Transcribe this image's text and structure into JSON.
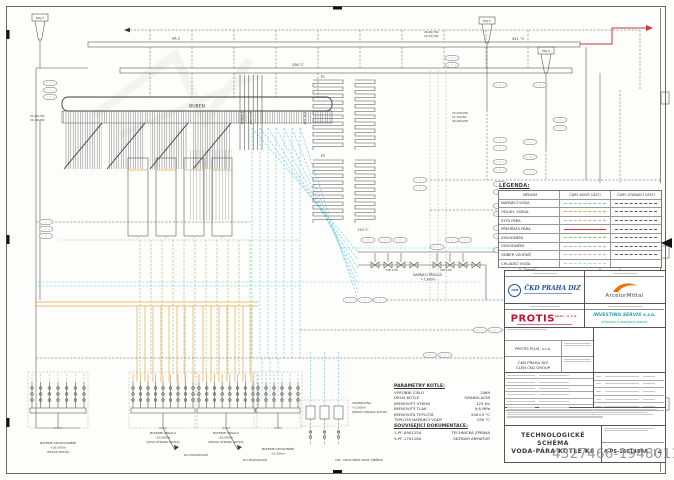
{
  "sheet": {
    "watermark": "4327466-19480111"
  },
  "colors": {
    "feedwater": "#6ec8dc",
    "blowdown": "#e2a84e",
    "saturated_steam": "#c0b890",
    "superheated_steam": "#cf3440",
    "flooding": "#8cc45e",
    "drain": "#b0b0b0",
    "sampling": "#dfa4c2",
    "cooling_water": "#a8dce8",
    "brand_blue": "#1b4e9b",
    "brand_red": "#c41230",
    "brand_orange": "#f06f00",
    "brand_teal": "#2aa0a8"
  },
  "legend": {
    "title": "LEGENDA:",
    "headers": [
      "MÉDIUM",
      "ČÁRY–NOVÉ ČÁSTI",
      "ČÁRY–STÁVAJÍCÍ ČÁSTI"
    ],
    "rows": [
      {
        "label": "NAPÁJECÍ VODA",
        "new": "#6ec8dc",
        "new_style": "dashed",
        "old_style": "dashed"
      },
      {
        "label": "ODLUH, ODKAL",
        "new": "#e2a84e",
        "new_style": "dashed",
        "old_style": "dashed"
      },
      {
        "label": "SYTÁ PÁRA",
        "new": "#c0b890",
        "new_style": "dashed",
        "old_style": "dashed"
      },
      {
        "label": "PŘEHŘÁTÁ PÁRA",
        "new": "#cf3440",
        "new_style": "solid",
        "old_style": "dashed"
      },
      {
        "label": "ZAVODNĚNÍ",
        "new": "#8cc45e",
        "new_style": "dashed",
        "old_style": "dashed"
      },
      {
        "label": "ODVODNĚNÍ",
        "new": "#b0b0b0",
        "new_style": "dashed",
        "old_style": "dashed"
      },
      {
        "label": "ODBĚR VZORKŮ",
        "new": "#dfa4c2",
        "new_style": "dashed",
        "old_style": "dashed"
      },
      {
        "label": "CHLADÍCÍ VODA",
        "new": "#a8dce8",
        "new_style": "dashed",
        "old_style": "none"
      }
    ]
  },
  "parameters": {
    "title": "PARAMETRY KOTLE:",
    "rows": [
      [
        "VÝROBNÍ ČÍSLO",
        "2069"
      ],
      [
        "DRUH KOTLE",
        "GRANULAČNÍ"
      ],
      [
        "JMENOVITÝ VÝKON",
        "125 t/h"
      ],
      [
        "JMENOVITÝ TLAK",
        "9,6 MPa"
      ],
      [
        "JMENOVITÁ TEPLOTA",
        "540±5 °C"
      ],
      [
        "TEPLOTA NAPÁJECÍ VODY",
        "190 °C"
      ]
    ]
  },
  "documentation": {
    "title": "SOUVISEJÍCÍ DOKUMENTACE:",
    "rows": [
      [
        "1-PF-0901250",
        "TECHNICKÁ ZPRÁVA"
      ],
      [
        "9-PF-1701180",
        "SEZNAM ARMATUR"
      ]
    ]
  },
  "title_block": {
    "ckd_circle": "ČKD",
    "ckd_name": "ČKD PRAHA DIZ",
    "arcelor_name": "ArcelorMittal",
    "protis_name": "PROTIS",
    "protis_sup": "spol. s r.o.",
    "investing_name": "INVESTING SERVIS s.r.o.",
    "investing_sub": "příprava a realizace staveb",
    "firm1": "PROTIS PLUS, s.r.o.",
    "firm2": "ČKD PRAHA DIZ",
    "firm2b": "ČLEN ČKD GROUP",
    "title_line1": "TECHNOLOGICKÉ SCHÉMA",
    "title_line2": "VODA-PÁRA KOTLE K8",
    "drawing_number": "4-PS-1601480A",
    "revision": "4"
  },
  "diagram": {
    "labels": {
      "buben": "BUBEN",
      "pojv": "POJ.V",
      "t541": "541 °C",
      "t536": "536 °C",
      "pr5": "PŘ 5",
      "p1": "P1",
      "p2": "P2",
      "d38": "Ø38x4,5",
      "d63": "Ø63,5x8",
      "d318": "Ø31,8x5",
      "dn100": "DN 100",
      "t190": "190 °C",
      "napaj1": "NAPÁJECÍ PŘÍSLUŠ.",
      "napaj2": "+7,300m",
      "ln1": "01-05/700",
      "ln2": "01-10/700",
      "ln3": "26-60/700",
      "ln4": "24-25/700",
      "ln5": "23-250/250",
      "ln6": "21-70/250",
      "ln7": "40-200/250",
      "bat1a": "BATERIE ODVZDUŠNĚNÍ",
      "bat1b": "+18,500m",
      "bat1c": "(STROP KOTLE)",
      "bat2a": "BATERIE ODKALU",
      "bat2b": "±0,000m",
      "bat2c": "(LEVÁ STRANA KOTLE)",
      "bat3c": "(PRAVÁ STRANA KOTLE)",
      "bat4a": "BATERIE ODVODNĚNÍ",
      "bat4b": "+1,500m",
      "zhas": "DO ZHÁŠOVAČE",
      "vz1": "VZORKOVNA",
      "vz2": "+1,500m",
      "vz3": "(PRAVÁ STRANA KOTLE)",
      "chl": "CHL. VODA PŘES KONT. MĚŘENÍ"
    }
  }
}
